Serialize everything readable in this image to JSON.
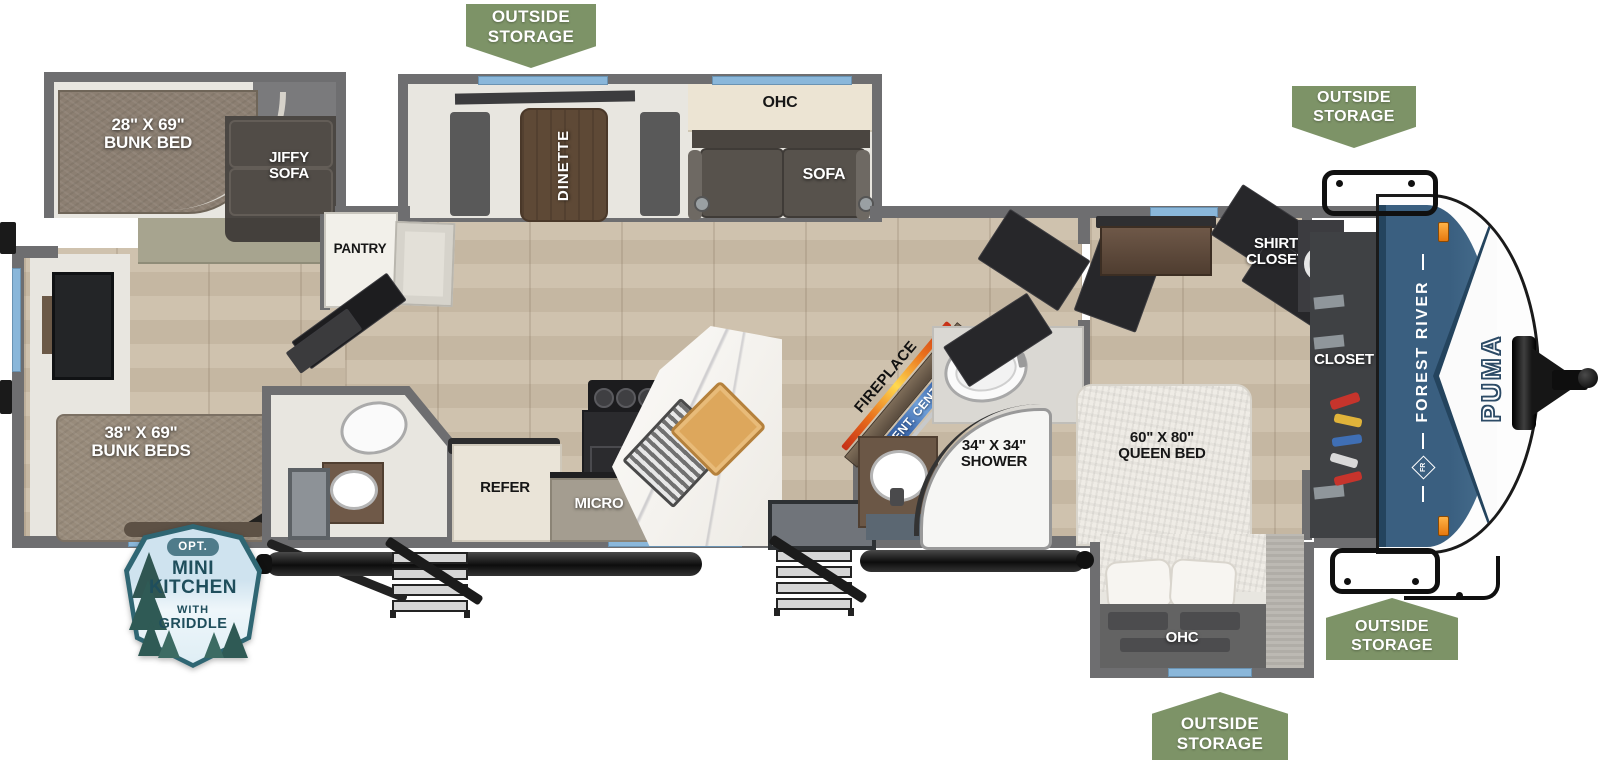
{
  "badges": {
    "top": "OUTSIDE\nSTORAGE",
    "front_upper": "OUTSIDE\nSTORAGE",
    "front_lower": "OUTSIDE\nSTORAGE",
    "bedroom": "OUTSIDE\nSTORAGE"
  },
  "option": {
    "tag": "OPT.",
    "title": "MINI\nKITCHEN",
    "subtitle_with": "WITH",
    "subtitle_griddle": "GRIDDLE"
  },
  "labels": {
    "bunk_bed_single": "28\" X 69\"\nBUNK BED",
    "jiffy_sofa": "JIFFY\nSOFA",
    "pantry": "PANTRY",
    "dinette": "DINETTE",
    "ohc_living": "OHC",
    "sofa": "SOFA",
    "bunk_beds_double": "38\" X 69\"\nBUNK BEDS",
    "refer": "REFER",
    "micro": "MICRO",
    "ohc_kitchen": "OHC",
    "fireplace": "FIREPLACE",
    "ent_center": "ENT. CENTER",
    "shower": "34\" X 34\"\nSHOWER",
    "shirt_closet": "SHIRT\nCLOSET",
    "queen_bed": "60\" X 80\"\nQUEEN BED",
    "closet": "CLOSET",
    "ohc_bedroom": "OHC"
  },
  "brand": {
    "make": "FOREST RIVER",
    "model": "PUMA",
    "monogram": "FR"
  },
  "colors": {
    "badge_green": "#7d9367",
    "wall_gray": "#6e6e70",
    "window_blue": "#8ab7da",
    "cap_blue": "#3a5f80",
    "ent_center_blue": "#3f6cb0",
    "flame_orange": "#f6a61f",
    "floor_wood": "#cbbda9"
  }
}
